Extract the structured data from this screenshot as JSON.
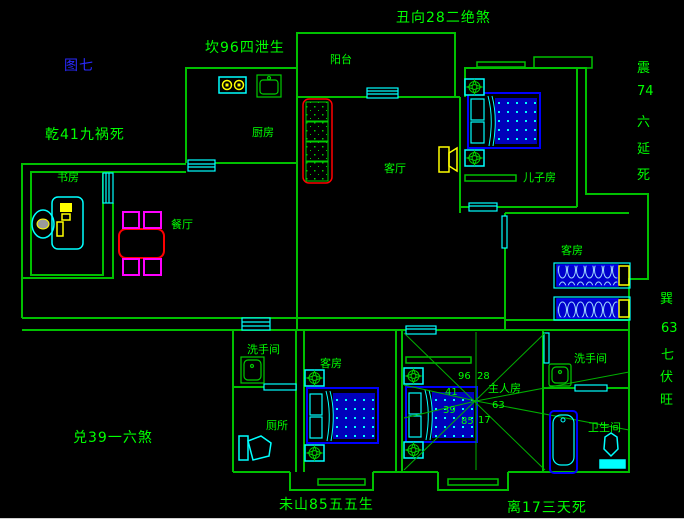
{
  "figure": {
    "label": "图七"
  },
  "fengshui": {
    "top": "丑向28二绝煞",
    "north": "坎96四泄生",
    "northwest": "乾41九祸死",
    "west": "兑39一六煞",
    "bottom": "未山85五五生",
    "south": "离17三天死",
    "east": [
      "震",
      "74",
      "六",
      "延",
      "死"
    ],
    "southeast": [
      "巽",
      "63",
      "七",
      "伏",
      "旺"
    ]
  },
  "rooms": {
    "balcony": "阳台",
    "kitchen": "厨房",
    "living": "客厅",
    "son_room": "儿子房",
    "dining": "餐厅",
    "study": "书房",
    "guest_right": "客房",
    "washroom_left": "洗手间",
    "toilet": "厕所",
    "guest_bottom": "客房",
    "master": "主人房",
    "washroom_right": "洗手间",
    "bathroom": "卫生间"
  },
  "compass_numbers": {
    "top_left": "96",
    "top_right": "28",
    "left_upper": "41",
    "left_lower": "39",
    "bottom_left": "85",
    "bottom_right": "17",
    "right": "63"
  },
  "colors": {
    "background": "#000000",
    "wall_green": "#00c000",
    "text_green": "#00ff00",
    "figure_blue": "#2a2aff",
    "furniture_blue": "#0000ff",
    "cyan": "#00ffff",
    "yellow": "#ffff00",
    "red": "#ff0000",
    "magenta": "#ff00ff"
  }
}
